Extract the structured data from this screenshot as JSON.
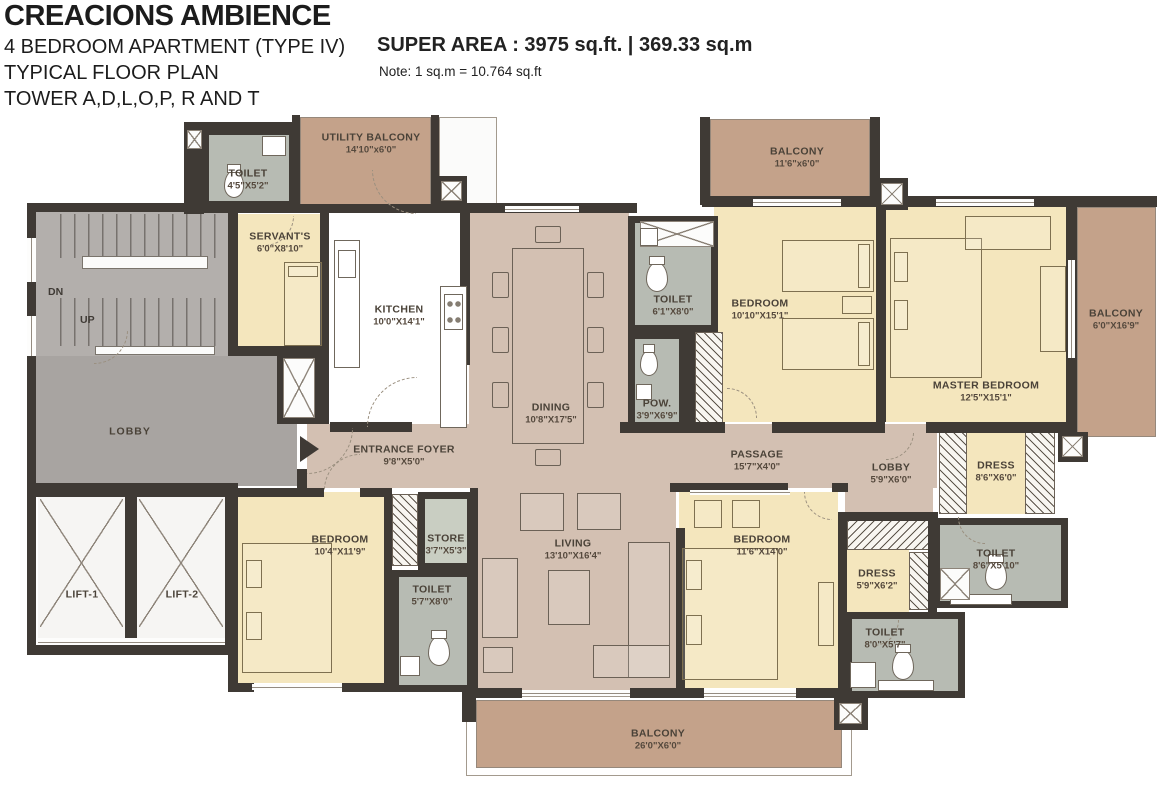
{
  "header": {
    "title": "CREACIONS AMBIENCE",
    "line2": "4 BEDROOM APARTMENT (TYPE IV)",
    "line3": "TYPICAL FLOOR PLAN",
    "line4": "TOWER A,D,L,O,P, R AND T",
    "super_area": "SUPER AREA : 3975 sq.ft. | 369.33 sq.m",
    "note": "Note: 1 sq.m = 10.764 sq.ft"
  },
  "stairs": {
    "dn": "DN",
    "up": "UP"
  },
  "rooms": [
    {
      "name": "UTILITY BALCONY",
      "dim": "14'10\"x6'0\""
    },
    {
      "name": "TOILET",
      "dim": "4'5\"X5'2\""
    },
    {
      "name": "SERVANT'S",
      "dim": "6'0\"X8'10\""
    },
    {
      "name": "KITCHEN",
      "dim": "10'0\"X14'1\""
    },
    {
      "name": "DINING",
      "dim": "10'8\"X17'5\""
    },
    {
      "name": "TOILET",
      "dim": "6'1\"X8'0\""
    },
    {
      "name": "POW.",
      "dim": "3'9\"X6'9\""
    },
    {
      "name": "BALCONY",
      "dim": "11'6\"x6'0\""
    },
    {
      "name": "BEDROOM",
      "dim": "10'10\"X15'1\""
    },
    {
      "name": "MASTER BEDROOM",
      "dim": "12'5\"X15'1\""
    },
    {
      "name": "BALCONY",
      "dim": "6'0\"X16'9\""
    },
    {
      "name": "ENTRANCE FOYER",
      "dim": "9'8\"X5'0\""
    },
    {
      "name": "PASSAGE",
      "dim": "15'7\"X4'0\""
    },
    {
      "name": "LOBBY",
      "dim": "5'9\"X6'0\""
    },
    {
      "name": "DRESS",
      "dim": "8'6\"X6'0\""
    },
    {
      "name": "TOILET",
      "dim": "8'6\"X5'10\""
    },
    {
      "name": "LOBBY",
      "dim": ""
    },
    {
      "name": "LIFT-1",
      "dim": ""
    },
    {
      "name": "LIFT-2",
      "dim": ""
    },
    {
      "name": "BEDROOM",
      "dim": "10'4\"X11'9\""
    },
    {
      "name": "STORE",
      "dim": "3'7\"X5'3\""
    },
    {
      "name": "TOILET",
      "dim": "5'7\"X8'0\""
    },
    {
      "name": "LIVING",
      "dim": "13'10\"X16'4\""
    },
    {
      "name": "BEDROOM",
      "dim": "11'6\"X14'0\""
    },
    {
      "name": "DRESS",
      "dim": "5'9\"X6'2\""
    },
    {
      "name": "TOILET",
      "dim": "8'0\"X5'7\""
    },
    {
      "name": "BALCONY",
      "dim": "26'0\"X6'0\""
    }
  ],
  "colors": {
    "wall": "#3f3a35",
    "open_area": "#d3c0b2",
    "bedroom": "#f4e6bd",
    "balcony": "#c4a28a",
    "toilet": "#b7bbb3",
    "store": "#c9cec2",
    "lobby": "#a8a4a1",
    "stairs": "#b3afac",
    "lift": "#f6f5f3",
    "kitchen": "#d9c3b3"
  }
}
